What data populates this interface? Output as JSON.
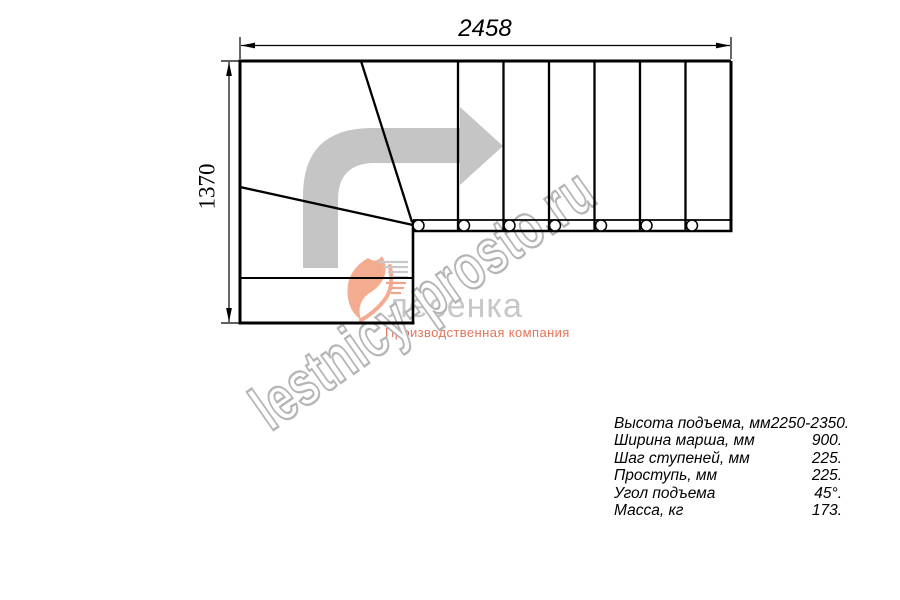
{
  "drawing": {
    "dim_width_label": "2458",
    "dim_height_label": "1370",
    "type": "staircase-plan-view",
    "straight_treads": 6,
    "winder_treads": 3,
    "stringer_bolt_circles": 7
  },
  "icons": {
    "direction_arrow": "l-shaped-arrow-turn-right",
    "logo_swoosh": "heart-swoosh-with-speed-lines"
  },
  "watermark": {
    "text": "lestnicy-prosto.ru"
  },
  "logo": {
    "name": "лесенка",
    "tagline": "Производственная компания"
  },
  "specs": {
    "rows": [
      {
        "label": "Высота подъема, мм",
        "value": "2250-2350."
      },
      {
        "label": "Ширина марша, мм",
        "value": "900."
      },
      {
        "label": "Шаг ступеней, мм",
        "value": "225."
      },
      {
        "label": "Проступь, мм",
        "value": "225."
      },
      {
        "label": "Угол подъема",
        "value": "45°."
      },
      {
        "label": "Масса, кг",
        "value": "173."
      }
    ]
  },
  "colors": {
    "line": "#000000",
    "arrow_gray": "#c5c5c5",
    "watermark_gray": "#b5b5b5",
    "logo_gray": "#c7c7c7",
    "logo_salmon": "#ef8e6d",
    "tagline_salmon": "#e4745a",
    "background": "#ffffff"
  }
}
